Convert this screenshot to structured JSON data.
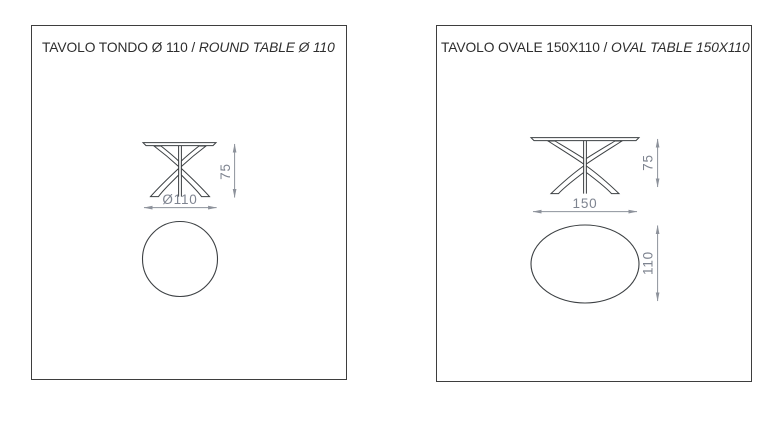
{
  "colors": {
    "background": "#ffffff",
    "panel_border": "#3e3e3e",
    "drawing_line": "#3c4043",
    "dimension_line": "#8d929b",
    "dimension_text": "#7e8490",
    "title_text": "#2e2e2e"
  },
  "panels": [
    {
      "name": "round-table",
      "title_italian": "TAVOLO TONDO Ø 110 /",
      "title_english": "ROUND TABLE Ø 110",
      "top_view_shape": "circle",
      "dims": {
        "height": "75",
        "diameter": "Ø110"
      }
    },
    {
      "name": "oval-table",
      "title_italian": "TAVOLO OVALE 150X110 /",
      "title_english": "OVAL TABLE 150X110",
      "top_view_shape": "oval",
      "dims": {
        "height": "75",
        "width": "150",
        "depth": "110"
      }
    }
  ]
}
